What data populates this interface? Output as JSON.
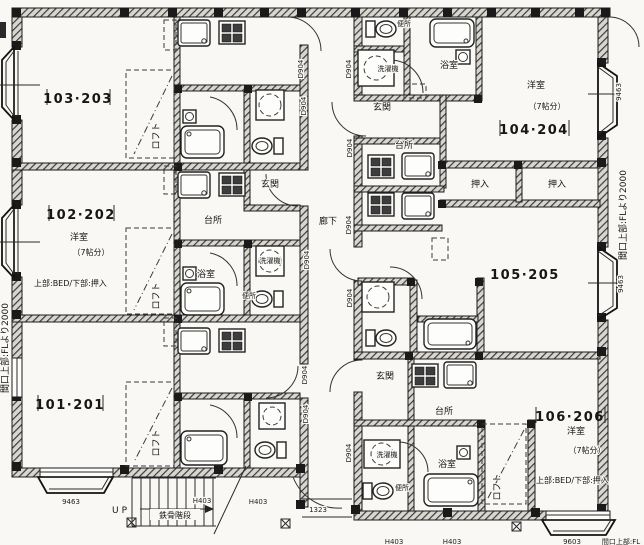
{
  "drawing": {
    "units": {
      "u101": {
        "label": "101·201"
      },
      "u102": {
        "label": "102·202",
        "room": "洋室",
        "size": "（7帖分）",
        "note": "上部:BED/下部:押入"
      },
      "u103": {
        "label": "103·203"
      },
      "u104": {
        "label": "104·204",
        "room": "洋室",
        "size": "（7帖分）"
      },
      "u105": {
        "label": "105·205"
      },
      "u106": {
        "label": "106·206",
        "room": "洋室",
        "size": "（7帖分）",
        "note": "上部:BED/下部:押入"
      }
    },
    "rooms": {
      "kitchen": "台所",
      "bath": "浴室",
      "toilet": "便所",
      "washer": "洗濯機",
      "entrance": "玄関",
      "closet": "押入",
      "corridor": "廊下",
      "loft": "ロフト"
    },
    "stairs": {
      "up": "UP",
      "label": "鉄骨階段"
    },
    "dims": {
      "d904": "D904",
      "h403": "H403",
      "w1323": "1323",
      "w9463": "9463",
      "w9603": "9603"
    },
    "notes": {
      "frontage": "間口上部:FLより2000",
      "frontage_short": "間口上部:FL"
    }
  }
}
